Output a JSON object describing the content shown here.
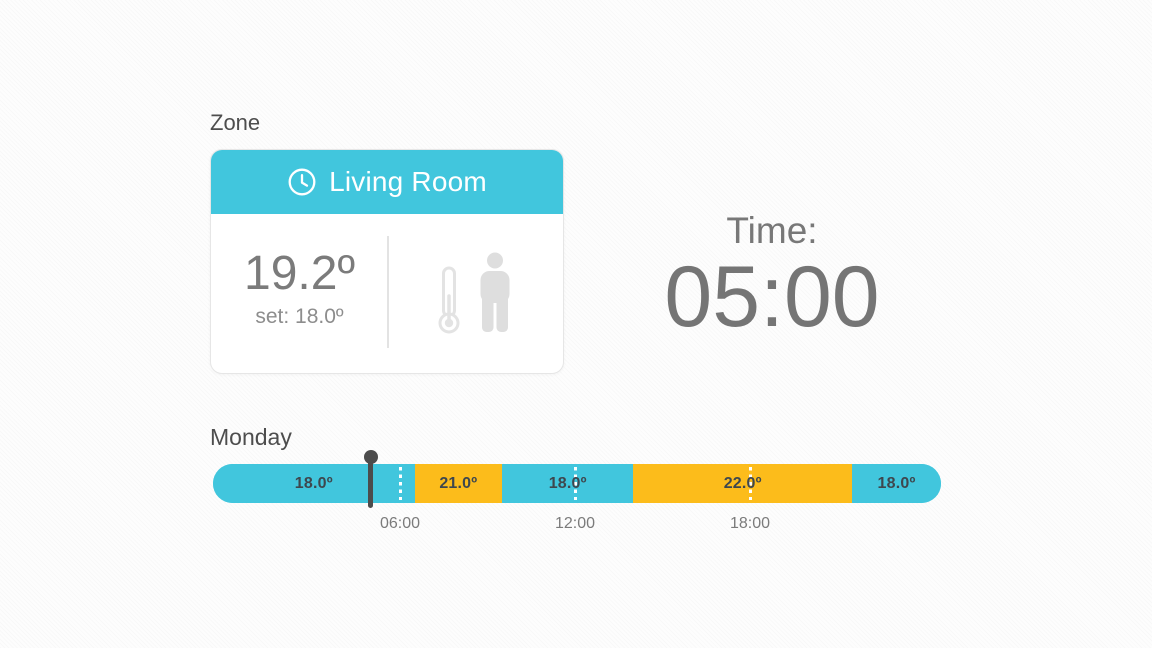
{
  "colors": {
    "accent_cyan": "#41c6dd",
    "accent_orange": "#fcbc1b",
    "pin": "#4c4c4c",
    "heading_text": "#4d4d4d",
    "value_text": "#7b7b7b"
  },
  "zone_card": {
    "section_label": "Zone",
    "room_name": "Living Room",
    "current_temperature": "19.2º",
    "set_temperature": "set: 18.0º"
  },
  "time_display": {
    "label": "Time:",
    "value": "05:00"
  },
  "schedule": {
    "day_label": "Monday",
    "current_time_hour": 5,
    "axis_ticks": [
      {
        "hour": 6,
        "label": "06:00"
      },
      {
        "hour": 12,
        "label": "12:00"
      },
      {
        "hour": 18,
        "label": "18:00"
      }
    ],
    "segments": [
      {
        "start_hour": 0,
        "end_hour": 6.5,
        "temperature_label": "18.0º",
        "color": "cyan"
      },
      {
        "start_hour": 6.5,
        "end_hour": 9.5,
        "temperature_label": "21.0º",
        "color": "orange"
      },
      {
        "start_hour": 9.5,
        "end_hour": 14,
        "temperature_label": "18.0º",
        "color": "cyan"
      },
      {
        "start_hour": 14,
        "end_hour": 21.5,
        "temperature_label": "22.0º",
        "color": "orange"
      },
      {
        "start_hour": 21.5,
        "end_hour": 24,
        "temperature_label": "18.0º",
        "color": "cyan"
      }
    ]
  }
}
